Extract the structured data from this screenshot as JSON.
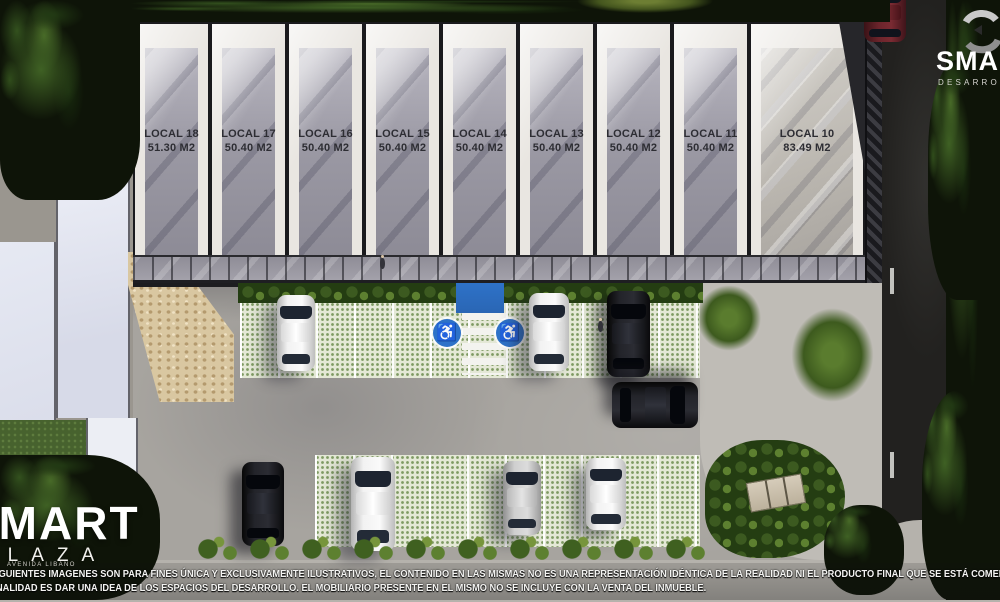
{
  "branding": {
    "developer": {
      "name": "SMART",
      "subtitle": "DESARROLLOS"
    },
    "project": {
      "name": "SMART",
      "subtitle": "PLAZA",
      "tagline": "AVENIDA LIBANO"
    }
  },
  "units": [
    {
      "label": "LOCAL 18",
      "area": "51.30 M2"
    },
    {
      "label": "LOCAL 17",
      "area": "50.40 M2"
    },
    {
      "label": "LOCAL 16",
      "area": "50.40 M2"
    },
    {
      "label": "LOCAL 15",
      "area": "50.40 M2"
    },
    {
      "label": "LOCAL 14",
      "area": "50.40 M2"
    },
    {
      "label": "LOCAL 13",
      "area": "50.40 M2"
    },
    {
      "label": "LOCAL 12",
      "area": "50.40 M2"
    },
    {
      "label": "LOCAL 11",
      "area": "50.40 M2"
    },
    {
      "label": "LOCAL 10",
      "area": "83.49 M2"
    }
  ],
  "disclaimer": {
    "line1": "IGUIENTES IMAGENES SON PARA FINES ÚNICA Y  EXCLUSIVAMENTE ILUSTRATIVOS, EL CONTENIDO EN LAS MISMAS NO ES UNA REPRESENTACIÓN IDÉNTICA DE LA REALIDAD NI EL PRODUCTO FINAL QUE SE ESTÁ COMERCIALIZA",
    "line2": "NALIDAD ES DAR UNA IDEA DE LOS ESPACIOS DEL DESARROLLO. EL MOBILIARIO PRESENTE EN EL MISMO NO SE INCLUYE CON LA VENTA DEL INMUEBLE."
  },
  "icons": {
    "handicap_parking": "♿"
  },
  "colors": {
    "accessible_blue": "#2e72c8",
    "paver_green": "#7e9a62",
    "concrete": "#a7a49f",
    "road_asphalt": "#22211f",
    "wall_white": "#e9e6e1"
  }
}
